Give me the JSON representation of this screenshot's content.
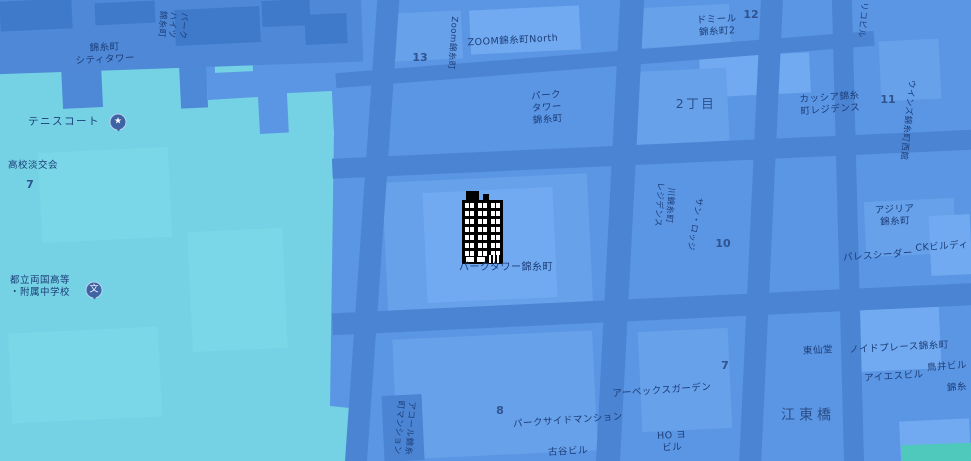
{
  "app": {
    "type": "map-view",
    "district": "Kinshicho / Kotobashi, Tokyo"
  },
  "colors": {
    "base_block": "#5b96e4",
    "road": "#4b84d3",
    "park_teal": "#74d2e4",
    "park_teal_light": "#7fdbe9",
    "park_green_corner": "#4fc9bb",
    "block_light": "#67a1ea",
    "block_lighter": "#71aaf0",
    "block_dark": "#3f7aca",
    "label_text": "#1d3d78",
    "locality_text": "#2b4d86",
    "badge": "#3e63a4",
    "landmark_icon": "#000000"
  },
  "icons": {
    "tennis_badge": "star-icon",
    "school_badge": "school-icon",
    "landmark": "black building with white windows",
    "tennis_glyph": "★",
    "school_glyph": "文"
  },
  "labels": {
    "city_tower": "錦糸町\nシティタワー",
    "heights_topleft": "パーク\nハイツ\n錦糸町",
    "tennis_court": "テニスコート",
    "tankokai": "高校淡交会",
    "tankokai_number": "7",
    "ryogoku_school": "都立両国高等\n・附属中学校",
    "block_13": "13",
    "zoom_kinshicho_vertical": "Zoom錦糸町",
    "zoom_kinshicho_north": "ZOOM錦糸町North",
    "park_tower_upper": "パーク\nタワー\n錦糸町",
    "domir_kinshicho": "ドミール\n錦糸町2",
    "block_12": "12",
    "riko_building": "リコビル",
    "ni_chome": "2丁目",
    "cassia_residence": "カッシア錦糸\n町レジデンス",
    "block_11": "11",
    "wins_west": "ウインズ錦糸町西館",
    "azalea_kinshicho": "アジリア\n錦糸町",
    "ck_building": "CKビルディ",
    "palace_cedar": "パレスシーダー",
    "park_tower_kinshicho": "パークタワー錦糸町",
    "kawa_residence": "川錦糸町\nレジデンス",
    "san_lodge": "サン・ロッジ",
    "block_10": "10",
    "block_7": "7",
    "apex_garden": "アーベックスガーデン",
    "block_8": "8",
    "parkside_mansion": "パークサイドマンション",
    "furuya_building": "古谷ビル",
    "ho_building": "HO ヨ\nビル",
    "accord_mansion": "アコール錦糸\n町マンション",
    "tosendo": "東仙堂",
    "noid_place": "ノイドプレース錦糸町",
    "ais_building": "アイエスビル",
    "torii_building": "鳥井ビル",
    "kinshi_partial": "錦糸",
    "kotobashi": "江東橋"
  }
}
